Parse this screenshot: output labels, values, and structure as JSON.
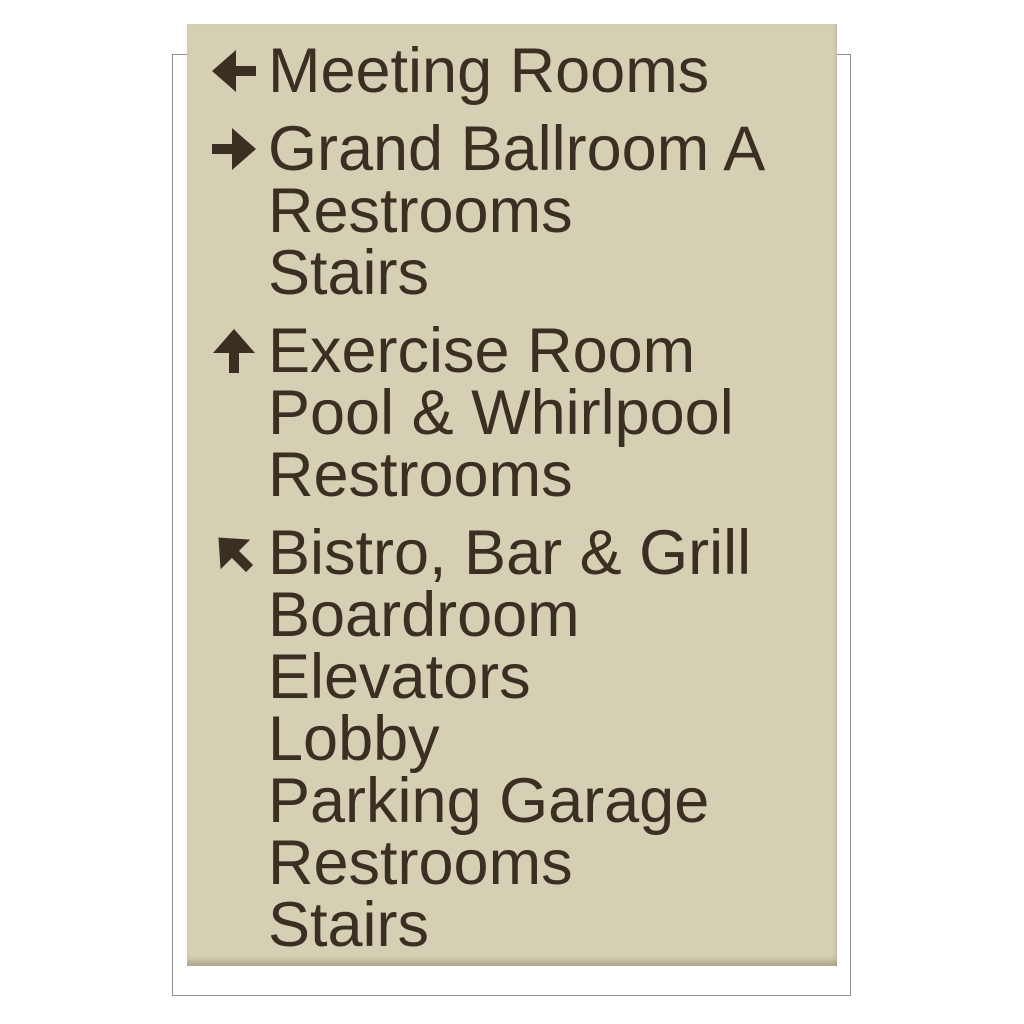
{
  "sign": {
    "panel_color": "#d5d0b4",
    "text_color": "#3b2e22",
    "backer_border_color": "#8e8e8e",
    "groups": [
      {
        "direction": "left",
        "icon": "arrow-left-icon",
        "destinations": [
          "Meeting Rooms"
        ]
      },
      {
        "direction": "right",
        "icon": "arrow-right-icon",
        "destinations": [
          "Grand Ballroom A",
          "Restrooms",
          "Stairs"
        ]
      },
      {
        "direction": "up",
        "icon": "arrow-up-icon",
        "destinations": [
          "Exercise Room",
          "Pool & Whirlpool",
          "Restrooms"
        ]
      },
      {
        "direction": "up-left",
        "icon": "arrow-up-left-icon",
        "destinations": [
          "Bistro, Bar & Grill",
          "Boardroom",
          "Elevators",
          "Lobby",
          "Parking Garage",
          "Restrooms",
          "Stairs"
        ]
      }
    ]
  }
}
